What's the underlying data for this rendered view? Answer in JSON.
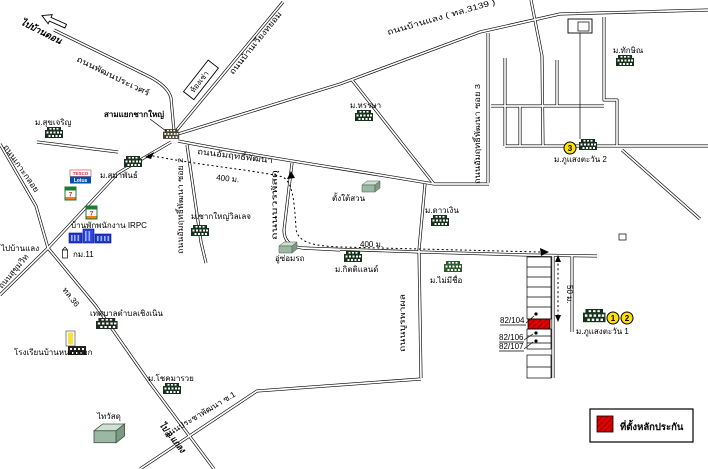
{
  "legend": {
    "title": "ที่ตั้งหลักประกัน"
  },
  "directions": {
    "to_ban_don": "ไปบ้านดอน",
    "to_ban_laeng": "ไปบ้านแลง",
    "to_klaeng": "ไป อ.แกลง"
  },
  "roads": {
    "pathon": "ถนนพัฒนประเวศร์",
    "wiang": "ถนนบ้านเวียงทยอม",
    "banlaeng": "ถนนบ้านแลง ( ทล.3139 )",
    "amrit": "ถนนอัมฤทธิ์พัฒนา",
    "amrit_soi2": "ถนนอัมฤทธิ์พัฒนา ซอย 2",
    "amrit_soi3": "ถนนอัมฤทธิ์พัฒนา ซอย 3",
    "bowon": "ถนนบวรพัสดุ",
    "burapha": "ถนนบูรพาผล",
    "kokkloi": "ถนนเกาะกลอย",
    "sukhumvit": "ถนนสุขุมวิท",
    "tl36": "ทล.36",
    "pracha": "ถนนประชาพัฒนา ซ.1"
  },
  "places": {
    "junction": "สามแยกชากใหญ่",
    "rental_rooms": "ห้องเช่า",
    "suk_charoen": "ม.สุขเจริญ",
    "hansa": "ม.หรรษา",
    "thaksin": "ม.ทักษิณ",
    "samaphan": "ม.สมาพันธ์",
    "chak_yai_village": "ม.ชากใหญ่วิลเลจ",
    "tang_tai_suan": "ตั้งใต้สวน",
    "dao_ngoen": "ม.ดาวเงิน",
    "garage": "อู่ซ่อมรถ",
    "kitti_land": "ม.กิตติแลนด์",
    "no_name": "ม.ไม่มีชื่อ",
    "phusaeng_tawan_2": "ม.ภูแสงตะวัน 2",
    "phusaeng_tawan_1": "ม.ภูแสงตะวัน 1",
    "chok_maruay": "ม.โชคมารวย",
    "municipality": "เทศบาลตำบลเชิงเนิน",
    "school": "โรงเรียนบ้านหนองจอก",
    "thai_watsadu": "ไทวัสดุ",
    "irpc_housing": "บ้านพักพนักงาน IRPC"
  },
  "markers": {
    "m1": "1",
    "m2": "2",
    "m3": "3"
  },
  "house_numbers": {
    "h104": "82/104",
    "h106": "82/106",
    "h107": "82/107"
  },
  "distances": {
    "d400_a": "400 ม.",
    "d400_b": "400 ม.",
    "d50": "50 ม."
  },
  "signs": {
    "tesco": "TESCO",
    "lotus": "Lotus",
    "seven": "7",
    "km11": "กม.11"
  },
  "colors": {
    "marker_yellow": "#ffe000",
    "collateral_red": "#e00000",
    "irpc_blue": "#2438c8",
    "lotus_blue": "#0050aa",
    "seven_green": "#1f7a33",
    "seven_orange": "#ef7d1a",
    "seven_red": "#d82a2a",
    "building_dark": "#16321c",
    "warehouse_green": "#9ab8a4"
  }
}
